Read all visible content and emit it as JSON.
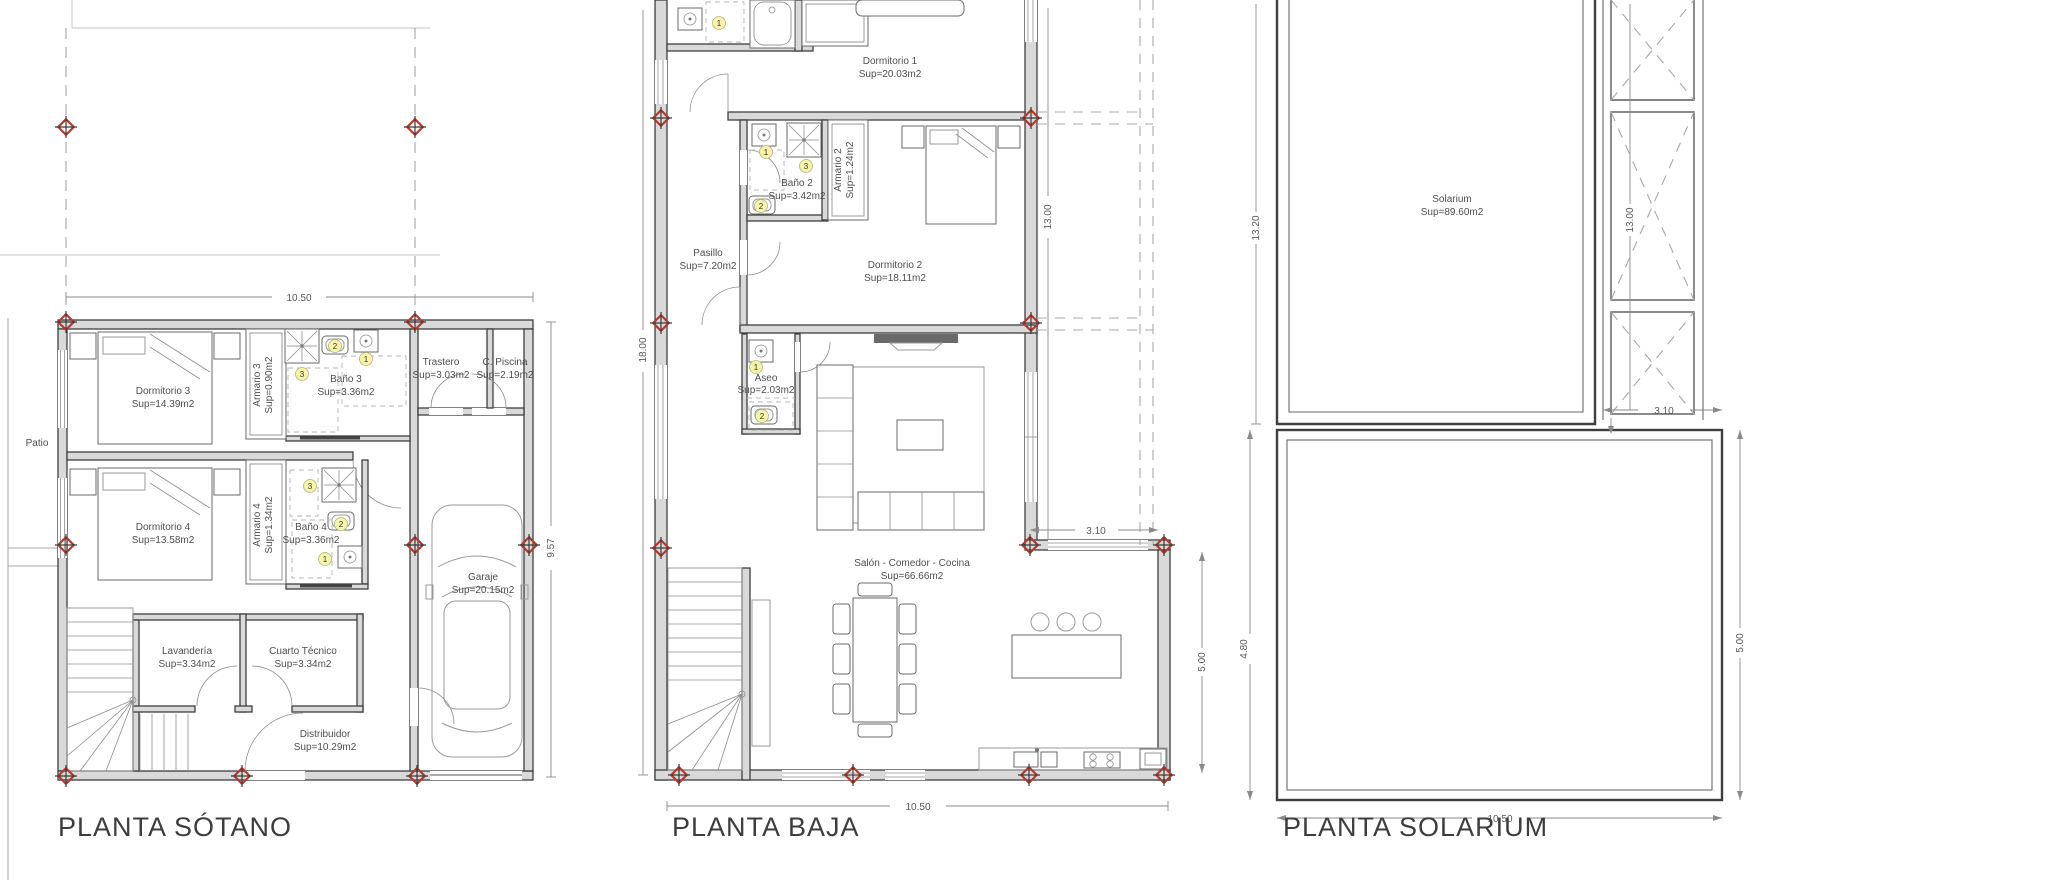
{
  "document": {
    "type": "architectural floor plan sheet",
    "language": "es"
  },
  "colors": {
    "background": "#ffffff",
    "wall_fill": "#d9d9d9",
    "line": "#4e4e4e",
    "grid_cross_red": "#b23a2f",
    "fixture_marker_yellow": "#f6f4a8"
  },
  "markers": {
    "m1": "1",
    "m2": "2",
    "m3": "3"
  },
  "plans": {
    "sotano": {
      "title": "PLANTA SÓTANO",
      "labels": {
        "patio": "Patio"
      },
      "rooms": {
        "dormitorio3": {
          "name": "Dormitorio 3",
          "area": "Sup=14.39m2"
        },
        "armario3": {
          "name": "Armario 3",
          "area": "Sup=0.90m2"
        },
        "bano3": {
          "name": "Baño 3",
          "area": "Sup=3.36m2"
        },
        "trastero": {
          "name": "Trastero",
          "area": "Sup=3.03m2"
        },
        "cpiscina": {
          "name": "C. Piscina",
          "area": "Sup=2.19m2"
        },
        "dormitorio4": {
          "name": "Dormitorio 4",
          "area": "Sup=13.58m2"
        },
        "armario4": {
          "name": "Armario 4",
          "area": "Sup=1.34m2"
        },
        "bano4": {
          "name": "Baño 4",
          "area": "Sup=3.36m2"
        },
        "lavanderia": {
          "name": "Lavandería",
          "area": "Sup=3.34m2"
        },
        "cuartotecnico": {
          "name": "Cuarto Técnico",
          "area": "Sup=3.34m2"
        },
        "distribuidor": {
          "name": "Distribuidor",
          "area": "Sup=10.29m2"
        },
        "garaje": {
          "name": "Garaje",
          "area": "Sup=20.15m2"
        }
      },
      "dims": {
        "width": "10.50",
        "height": "9.57"
      }
    },
    "baja": {
      "title": "PLANTA BAJA",
      "rooms": {
        "dormitorio1": {
          "name": "Dormitorio 1",
          "area": "Sup=20.03m2"
        },
        "bano2": {
          "name": "Baño 2",
          "area": "Sup=3.42m2"
        },
        "armario2": {
          "name": "Armario 2",
          "area": "Sup=1.24m2"
        },
        "dormitorio2": {
          "name": "Dormitorio 2",
          "area": "Sup=18.11m2"
        },
        "pasillo": {
          "name": "Pasillo",
          "area": "Sup=7.20m2"
        },
        "aseo": {
          "name": "Aseo",
          "area": "Sup=2.03m2"
        },
        "salon": {
          "name": "Salón - Comedor - Cocina",
          "area": "Sup=66.66m2"
        }
      },
      "dims": {
        "height_total": "18.00",
        "height_upper": "13.00",
        "terrace_width": "3.10",
        "terrace_height": "5.00",
        "width": "10.50"
      }
    },
    "solarium": {
      "title": "PLANTA SOLARIUM",
      "rooms": {
        "solarium": {
          "name": "Solarium",
          "area": "Sup=89.60m2"
        }
      },
      "dims": {
        "height_left": "13.20",
        "height_right": "13.00",
        "strip_width": "3.10",
        "terrace_left": "4.80",
        "terrace_right": "5.00",
        "width": "10.50"
      }
    }
  }
}
